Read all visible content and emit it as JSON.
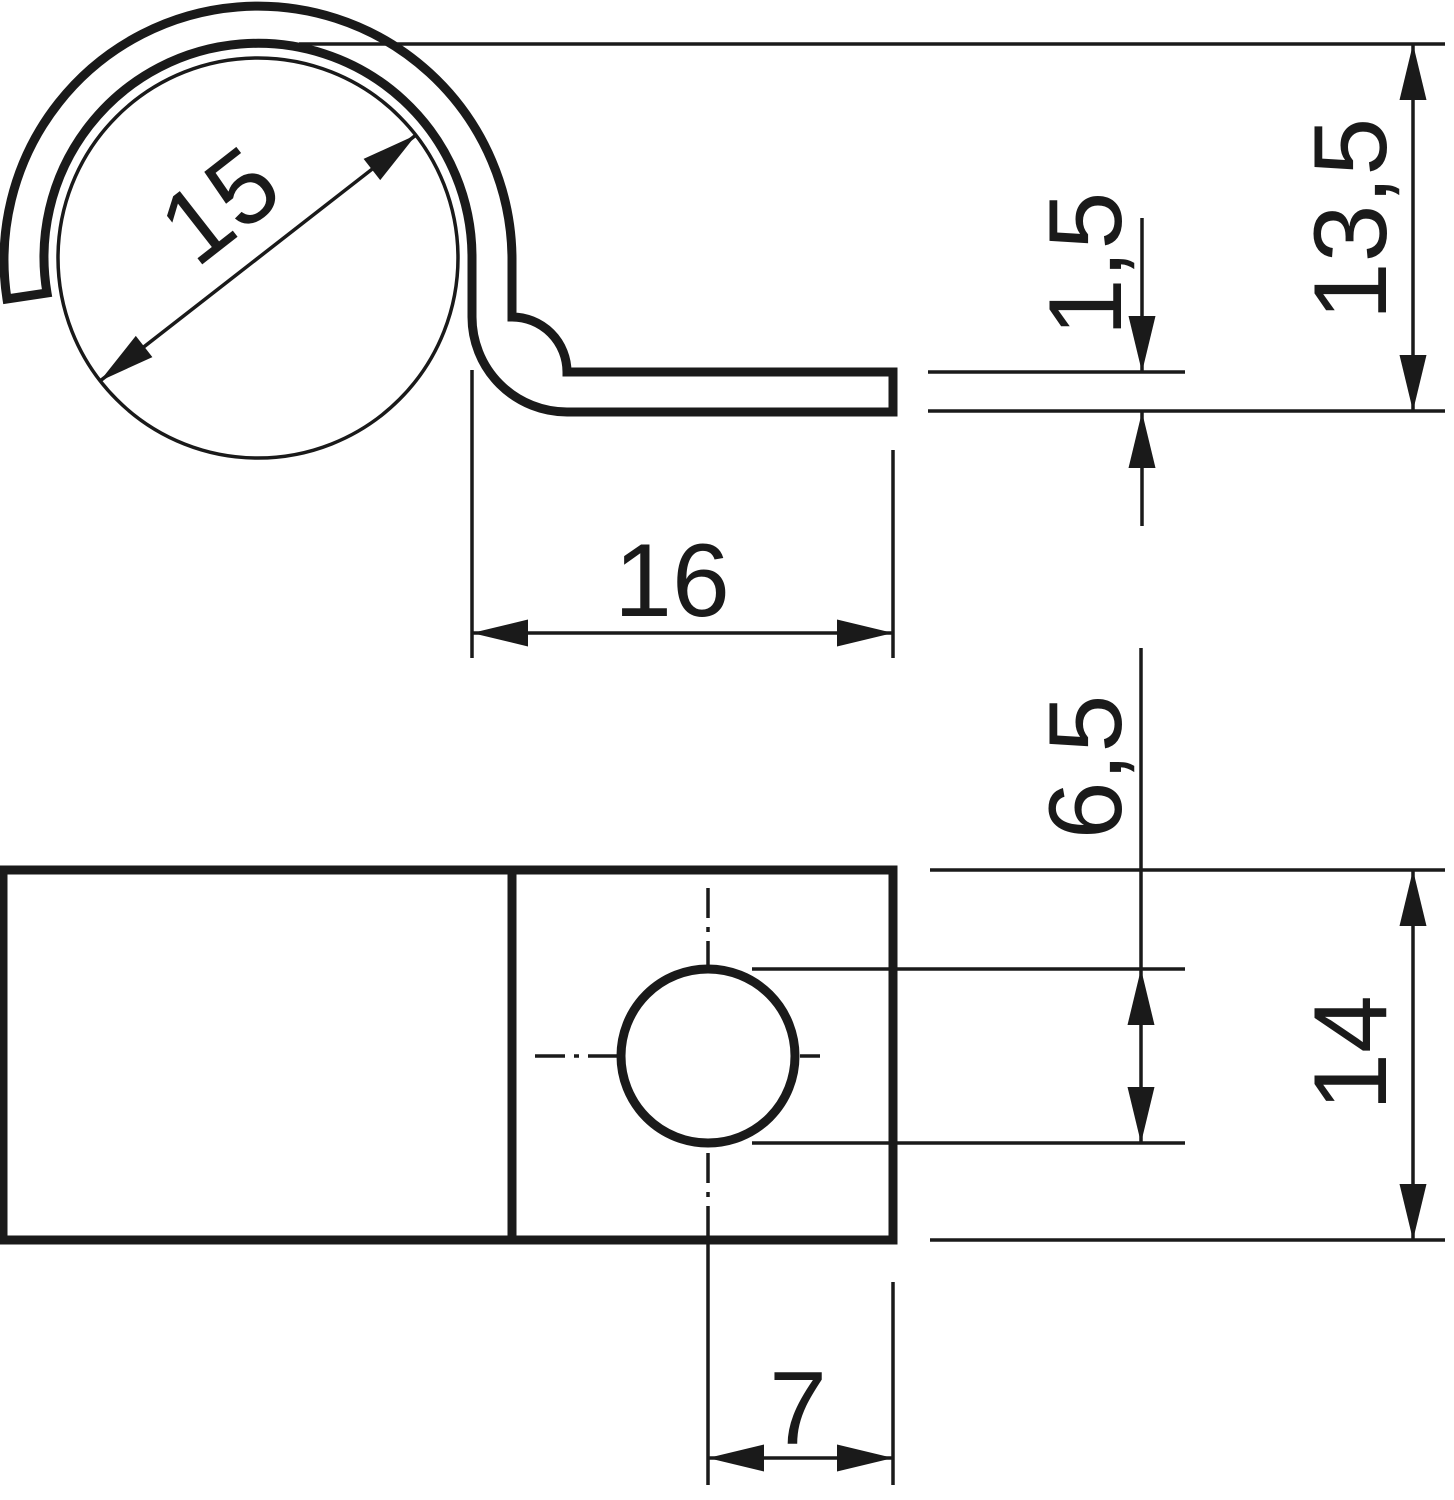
{
  "drawing": {
    "kind": "technical-drawing-cable-clip",
    "ink_color": "#1a1a1a",
    "background_color": "#ffffff",
    "views": [
      "side-view",
      "plan-view"
    ]
  },
  "dimensions": {
    "inner_diameter": "15",
    "tab_length": "16",
    "material_thickness": "1,5",
    "overall_height": "13,5",
    "hole_diameter": "6,5",
    "strap_width": "14",
    "hole_center_to_end": "7"
  }
}
